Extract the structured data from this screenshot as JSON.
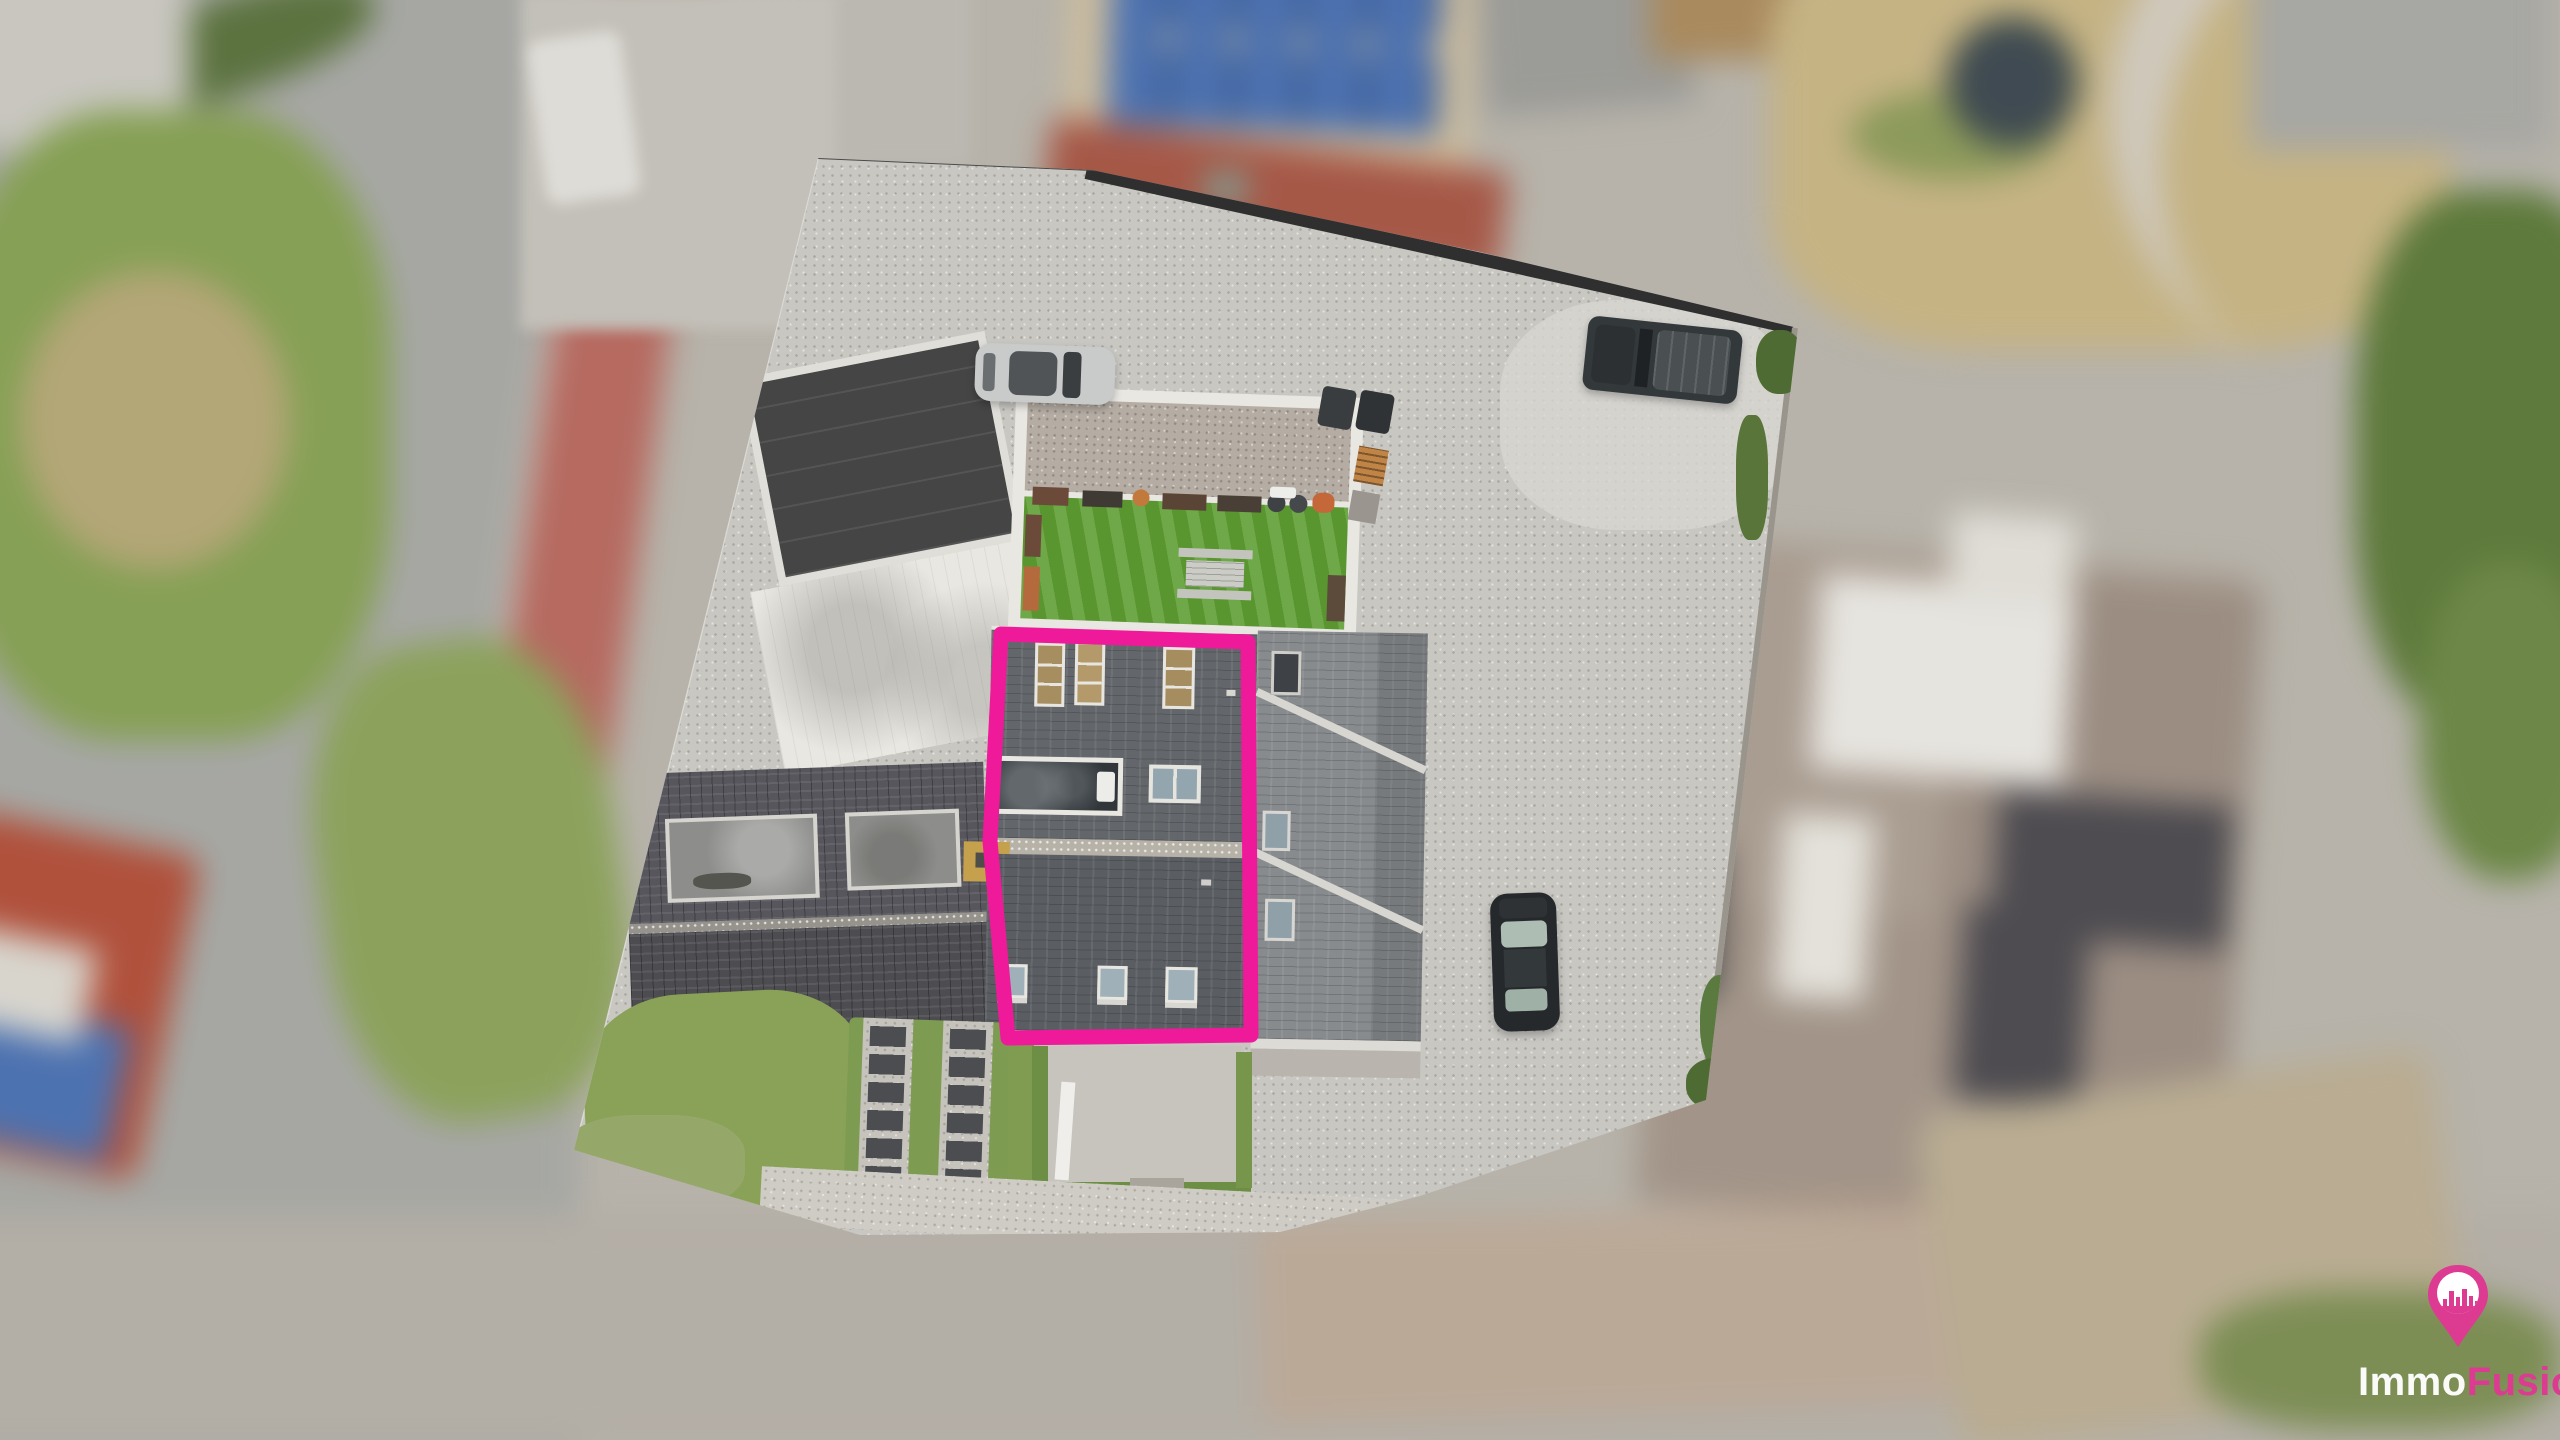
{
  "image": {
    "kind": "aerial-drone-photograph",
    "subject": "real-estate listing photo: top-down view of a property complex with one building highlighted by a pink outline, tilt-shift blur on the surroundings"
  },
  "watermark": {
    "brand_prefix": "Immo",
    "brand_suffix": "Fusion",
    "icon": "map-pin-with-city-skyline"
  },
  "scene": {
    "highlighted_building": "dark slate mansard roof with three amber roof windows, large glazed opening, chimney and three lower dormer windows",
    "other_features": [
      "gravel parking lot",
      "artificial turf courtyard with picnic table",
      "flat-roof outbuilding",
      "tiled-roof side building",
      "silver car",
      "dark SUV",
      "dark sedan",
      "stepping-stone parking strips",
      "neighbouring houses with solar panels",
      "roads with red cycle lane"
    ]
  },
  "colors": {
    "highlight_pink": "#ef1a9a",
    "logo_pink": "#dd3a92",
    "turf_green": "#5f9e33",
    "grass_green": "#86a055",
    "road_red": "#b66a60",
    "solar_blue": "#4d72b0",
    "brick_red": "#a65847",
    "gravel_grey": "#c9c7c2",
    "slate_grey": "#63676b",
    "lawn_tan": "#c5b384",
    "tree_green": "#5e7a3c",
    "neighbor_roof_taupe": "#a99c90"
  }
}
